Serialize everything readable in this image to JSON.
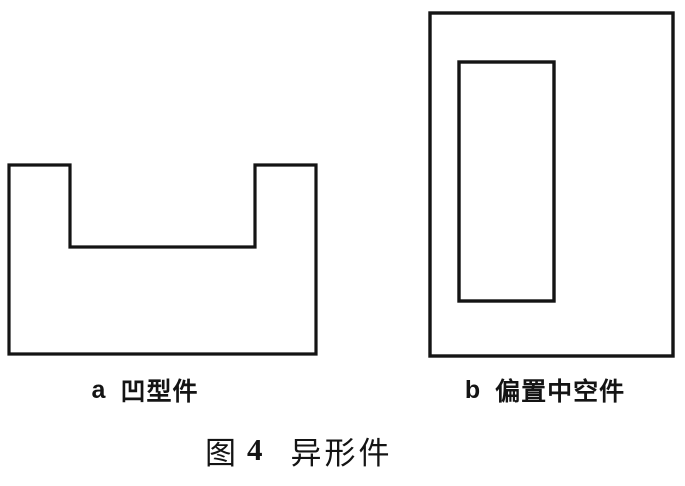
{
  "figure": {
    "panels": [
      {
        "letter": "a",
        "label": "凹型件"
      },
      {
        "letter": "b",
        "label": "偏置中空件"
      }
    ],
    "caption": {
      "prefix": "图",
      "number": "4",
      "title": "异形件"
    }
  },
  "shapes": {
    "panel_a": "u-shaped-concave-outline",
    "panel_b_outer": "outer-rectangle",
    "panel_b_inner": "offset-inner-rectangle"
  },
  "colors": {
    "line": "#141414",
    "text": "#141414",
    "background": "#ffffff"
  }
}
